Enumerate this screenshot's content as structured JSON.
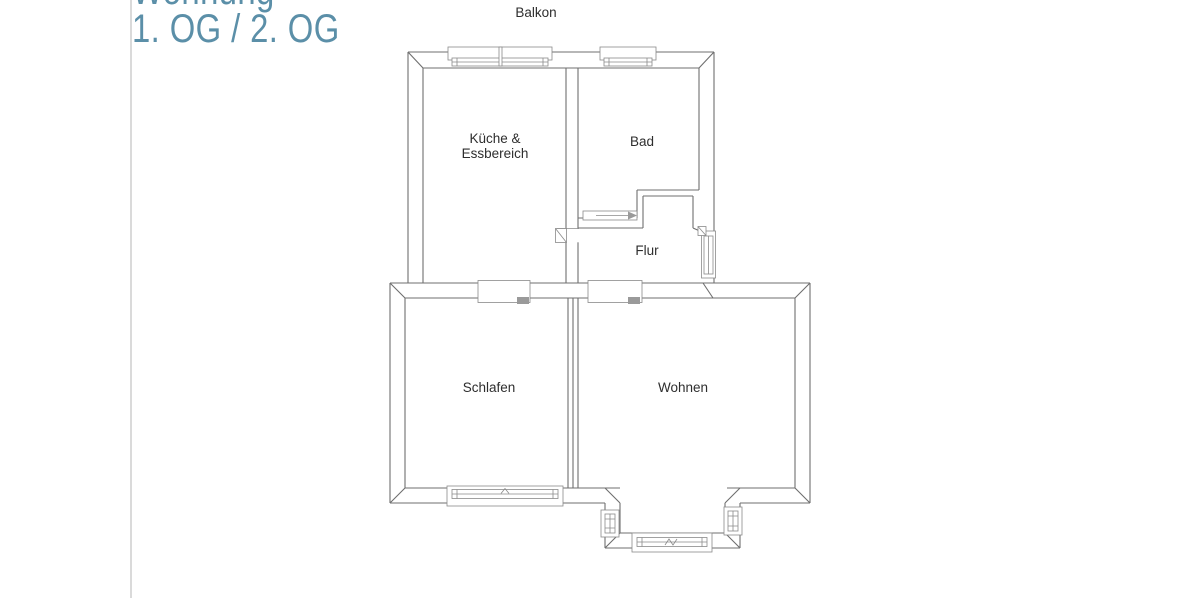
{
  "page": {
    "background": "#ffffff",
    "separator_color": "#dadada"
  },
  "title": {
    "line1": "Wohnung",
    "line2": "1. OG / 2. OG",
    "color": "#5b8fa8"
  },
  "floorplan": {
    "wall_color": "#6f6f6f",
    "window_color": "#8a8a8a",
    "label_color": "#2e2e2e",
    "labels": {
      "balcony": "Balkon",
      "kitchen_line1": "Küche &",
      "kitchen_line2": "Essbereich",
      "bath": "Bad",
      "hall": "Flur",
      "bedroom": "Schlafen",
      "living": "Wohnen"
    }
  }
}
